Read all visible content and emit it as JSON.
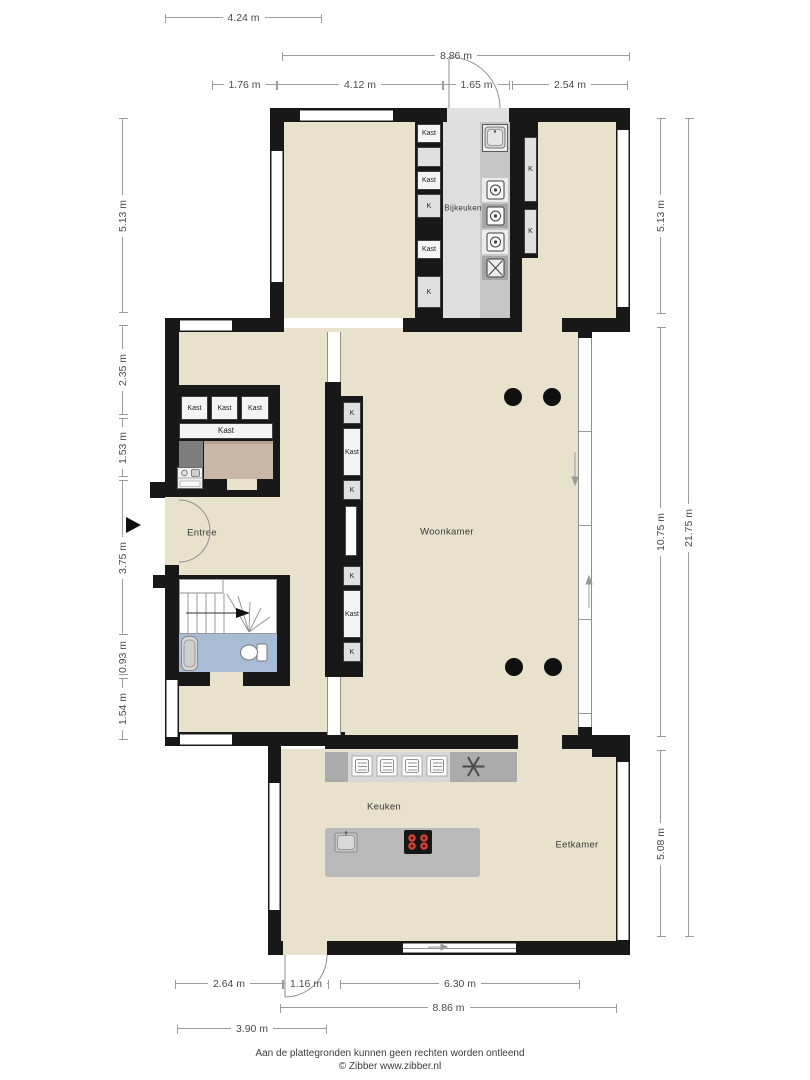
{
  "rooms": {
    "bijkeuken": "Bijkeuken",
    "woonkamer": "Woonkamer",
    "keuken": "Keuken",
    "eetkamer": "Eetkamer",
    "entree": "Entree"
  },
  "labels": {
    "kast": "Kast",
    "k": "K"
  },
  "dimensions": {
    "top": [
      "4.24 m",
      "8.86 m",
      "1.76 m",
      "4.12 m",
      "1.65 m",
      "2.54 m"
    ],
    "left": [
      "5.13 m",
      "2.35 m",
      "1.53 m",
      "3.75 m",
      "0.93 m",
      "1.54 m"
    ],
    "right": [
      "5.13 m",
      "10.75 m",
      "5.08 m",
      "21.75 m"
    ],
    "bottom": [
      "2.64 m",
      "1.16 m",
      "6.30 m",
      "8.86 m",
      "3.90 m"
    ]
  },
  "footer": {
    "line1": "Aan de plattegronden kunnen geen rechten worden ontleend",
    "line2": "© Zibber www.zibber.nl"
  },
  "icons": [
    "entrance-arrow",
    "door-swing",
    "double-door-swing",
    "window",
    "sliding-glass-wall",
    "washing-machine",
    "appliance",
    "sink",
    "oven",
    "extractor-fan",
    "induction-hob",
    "toilet",
    "washbasin",
    "stairs",
    "slide-arrow",
    "column-dot"
  ],
  "colors": {
    "wall": "#181818",
    "floor": "#e8e1cb",
    "utility_floor": "#dedede",
    "bathroom_floor": "#a9bcd6",
    "storage_floor": "#c8b7a7",
    "counter_light": "#d8d8d8",
    "counter_dark": "#ababab",
    "island": "#b9b9b9",
    "hob_burner": "#cd4437"
  }
}
